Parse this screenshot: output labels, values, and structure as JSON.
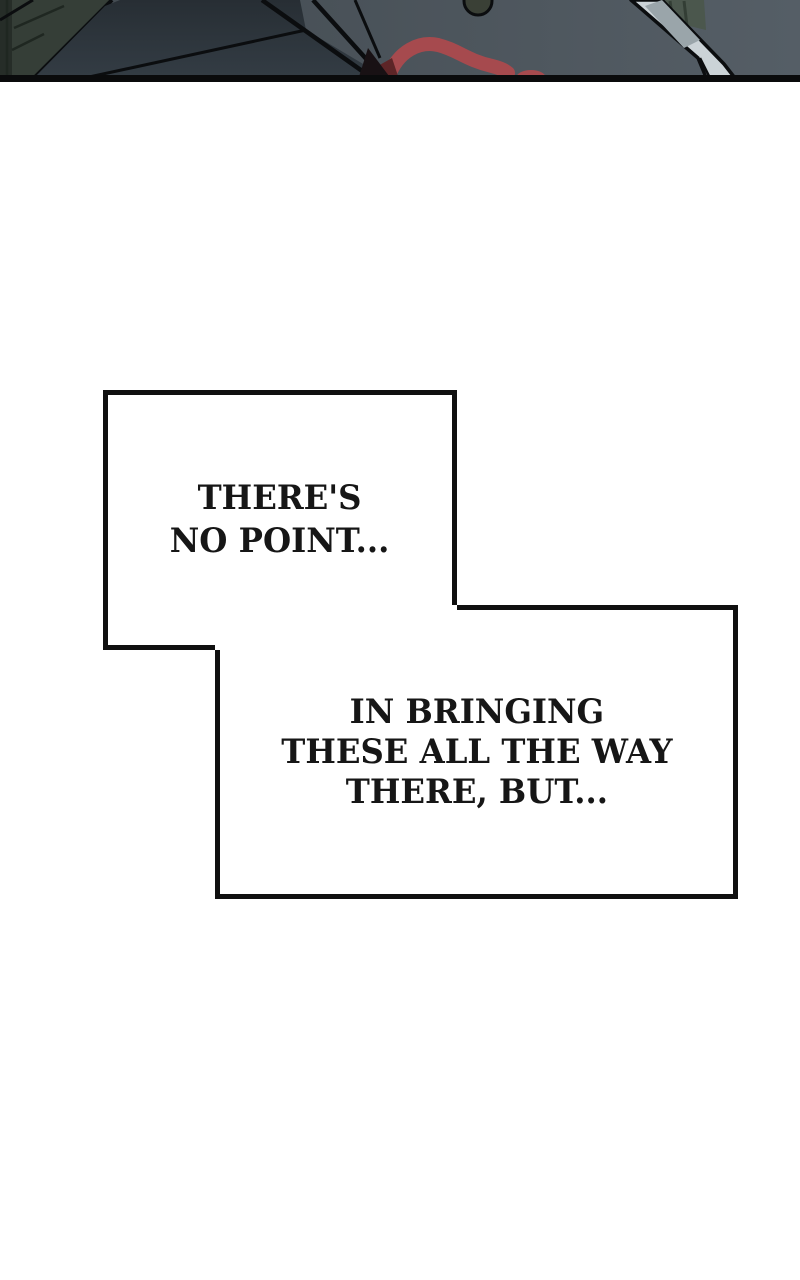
{
  "comic": {
    "panel": {
      "alt": "dark slate room: green door at left, black diagonal straps, red blood smear, pale cloth at right, thick black panel border below",
      "palette": {
        "bg_left": "#41494f",
        "bg_right": "#555e66",
        "door": "#353e37",
        "door_dark": "#262d28",
        "door_line": "#1f2721",
        "outline": "#0b0d0f",
        "mass_top": "#343d45",
        "mass_bottom": "#272e34",
        "blood": "#a64a4e",
        "blood_dark": "#5d2527",
        "wedge": "#181114",
        "knob": "#3a4036",
        "cloth": "#cbd3d7",
        "cloth_shadow": "#9aa5aa",
        "foliage": "#4b574d",
        "foliage_line": "#333e35",
        "band": "#0a0b0c"
      }
    },
    "colors": {
      "page_bg": "#ffffff",
      "bubble_fill": "#ffffff",
      "bubble_border": "#101010",
      "text": "#161616"
    },
    "bubbles": [
      {
        "lines": [
          "THERE'S",
          "NO POINT..."
        ]
      },
      {
        "lines": [
          "IN BRINGING",
          "THESE ALL THE WAY",
          "THERE, BUT..."
        ]
      }
    ]
  }
}
